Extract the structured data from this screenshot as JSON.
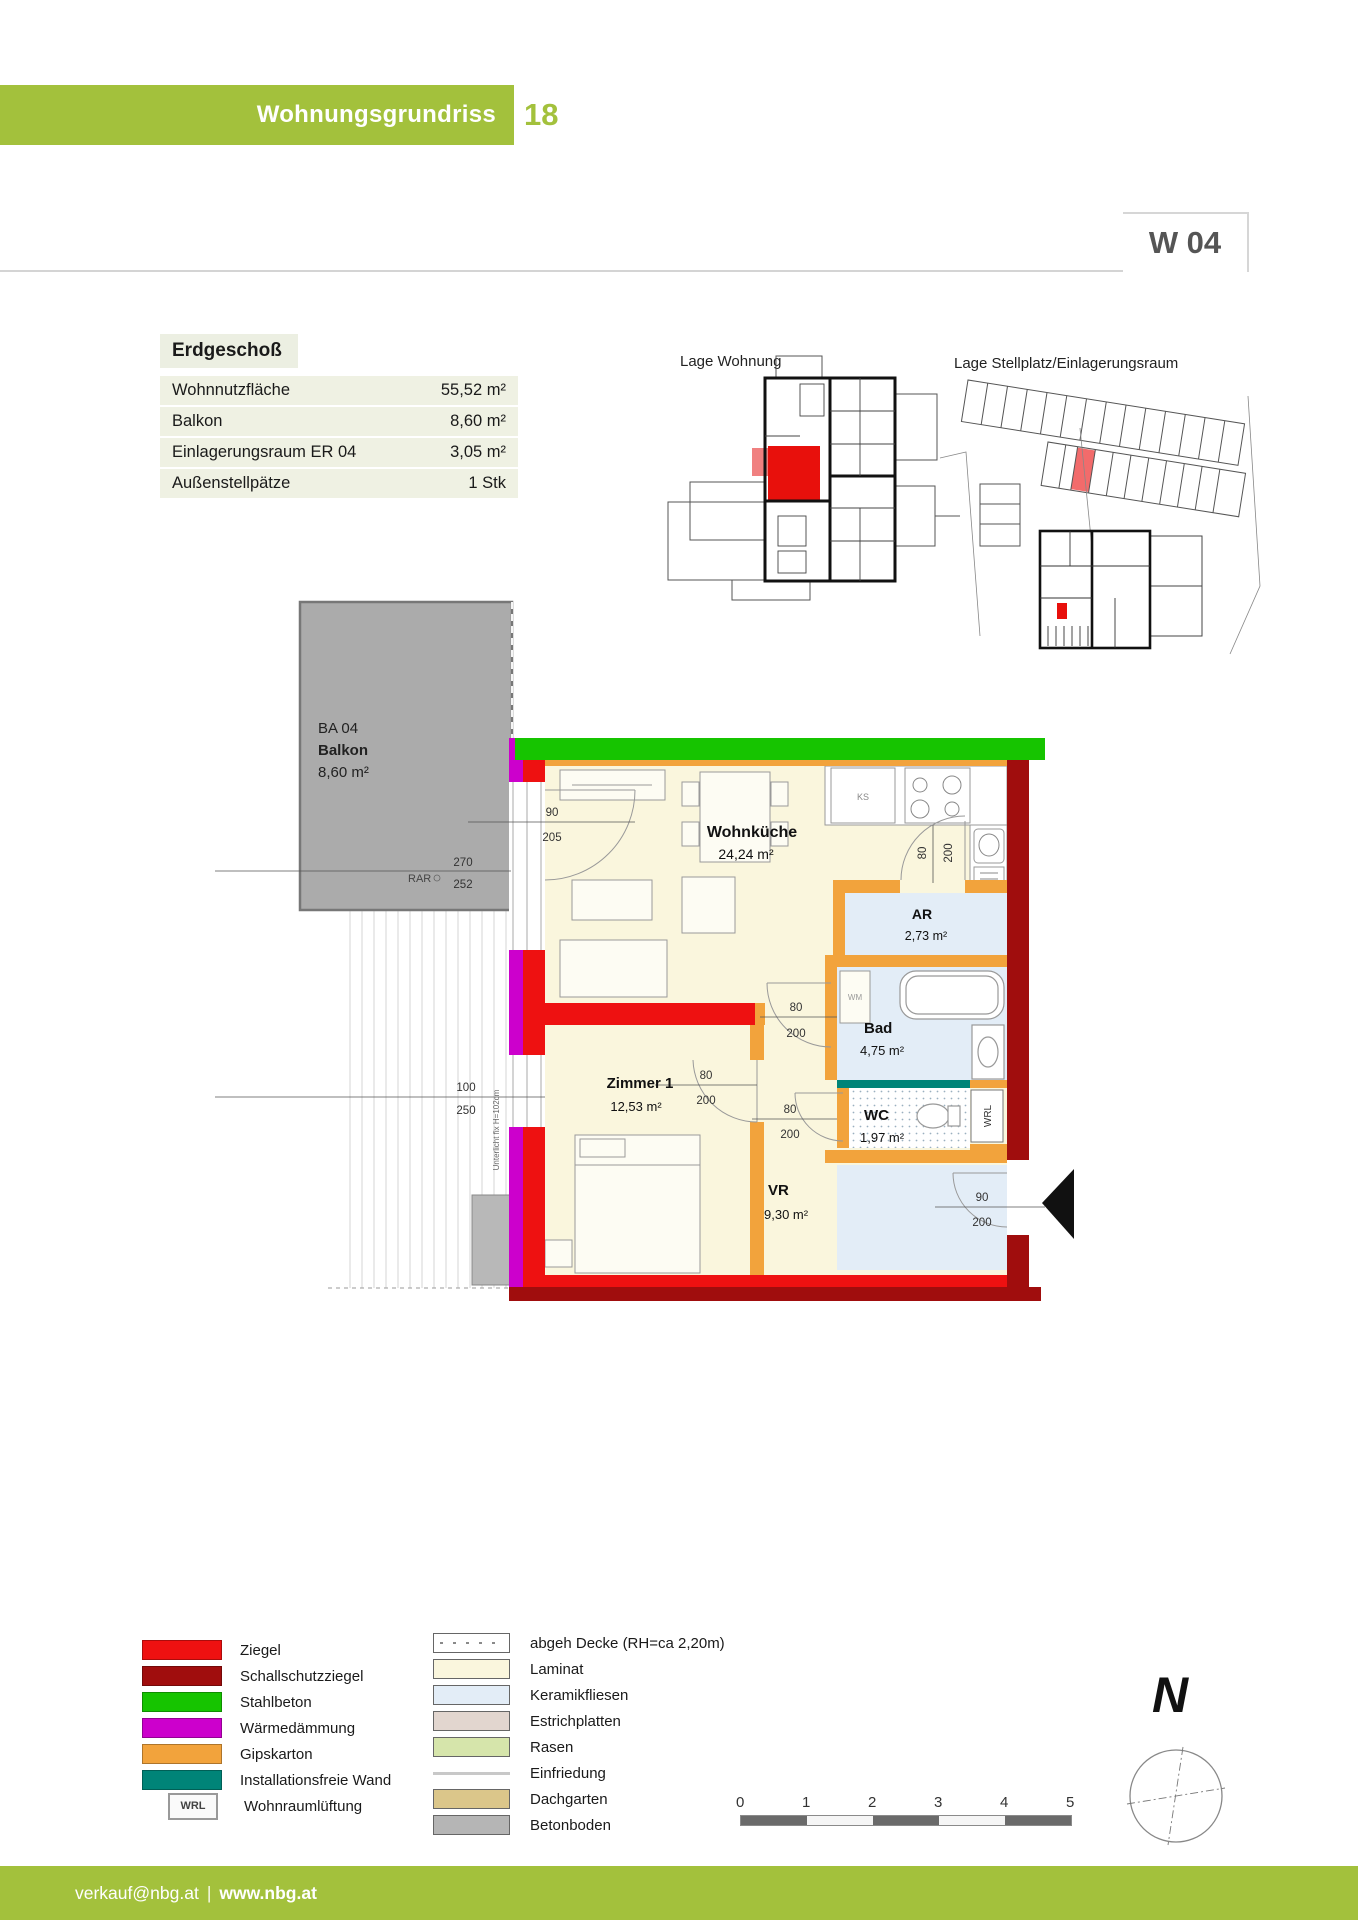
{
  "header": {
    "title": "Wohnungsgrundriss",
    "page_number": "18"
  },
  "unit_badge": "W 04",
  "info": {
    "floor_label": "Erdgeschoß",
    "rows": [
      {
        "label": "Wohnnutzfläche",
        "value": "55,52 m²"
      },
      {
        "label": "Balkon",
        "value": "8,60 m²"
      },
      {
        "label": "Einlagerungsraum ER 04",
        "value": "3,05 m²"
      },
      {
        "label": "Außenstellpätze",
        "value": "1 Stk"
      }
    ]
  },
  "site_plans": {
    "apartment_title": "Lage Wohnung",
    "parking_title": "Lage Stellplatz/Einlagerungsraum"
  },
  "floor_plan": {
    "rooms": {
      "wohnkueche": {
        "name": "Wohnküche",
        "area": "24,24 m²"
      },
      "ar": {
        "name": "AR",
        "area": "2,73 m²"
      },
      "bad": {
        "name": "Bad",
        "area": "4,75 m²"
      },
      "wc": {
        "name": "WC",
        "area": "1,97 m²"
      },
      "vr": {
        "name": "VR",
        "area": "9,30 m²"
      },
      "zimmer1": {
        "name": "Zimmer 1",
        "area": "12,53 m²"
      }
    },
    "balcony": {
      "code": "BA 04",
      "name": "Balkon",
      "area": "8,60 m²"
    },
    "annotations": {
      "rar": "RAR",
      "ks": "KS",
      "wm": "WM",
      "wrl": "WRL",
      "window_note": "Unterlicht fix H=102cm"
    },
    "dims": {
      "balcony_door": {
        "w": "90",
        "h": "205"
      },
      "balcony_element": {
        "w": "270",
        "h": "252"
      },
      "zimmer_window": {
        "w": "100",
        "h": "250"
      },
      "ar_door": {
        "w": "80",
        "h": "200"
      },
      "bad_door": {
        "w": "80",
        "h": "200"
      },
      "wc_door": {
        "w": "80",
        "h": "200"
      },
      "zimmer_door": {
        "w": "80",
        "h": "200"
      },
      "entrance_door": {
        "w": "90",
        "h": "200"
      }
    }
  },
  "legend": {
    "left": [
      {
        "label": "Ziegel",
        "color": "#ee1111"
      },
      {
        "label": "Schallschutzziegel",
        "color": "#a00d0d"
      },
      {
        "label": "Stahlbeton",
        "color": "#16c400"
      },
      {
        "label": "Wärmedämmung",
        "color": "#cc00cc"
      },
      {
        "label": "Gipskarton",
        "color": "#f2a33c"
      },
      {
        "label": "Installationsfreie Wand",
        "color": "#008478"
      },
      {
        "label": "Wohnraumlüftung",
        "badge": "WRL"
      }
    ],
    "right": [
      {
        "label": "abgeh Decke (RH=ca 2,20m)"
      },
      {
        "label": "Laminat",
        "color": "#faf6dd"
      },
      {
        "label": "Keramikfliesen",
        "color": "#e3edf7"
      },
      {
        "label": "Estrichplatten",
        "color": "#e2d6cf"
      },
      {
        "label": "Rasen",
        "color": "#d6e5ab"
      },
      {
        "label": "Einfriedung",
        "color": "#c8c8c8"
      },
      {
        "label": "Dachgarten",
        "color": "#dbc68a"
      },
      {
        "label": "Betonboden",
        "color": "#b5b5b5"
      }
    ]
  },
  "scale_bar": {
    "ticks": [
      "0",
      "1",
      "2",
      "3",
      "4",
      "5"
    ]
  },
  "compass": {
    "north_label": "N"
  },
  "footer": {
    "email": "verkauf@nbg.at",
    "separator": "|",
    "website": "www.nbg.at"
  },
  "colors": {
    "accent_green": "#a3c13c",
    "ziegel": "#ee1111",
    "schallschutzziegel": "#a00d0d",
    "stahlbeton": "#16c400",
    "waermedaemmung": "#cc00cc",
    "gipskarton": "#f2a33c",
    "installationsfreie_wand": "#008478",
    "laminat": "#faf6dd",
    "keramikfliesen": "#e3edf7",
    "balkon_grau": "#ababab",
    "highlight_rot": "#e8100c"
  }
}
